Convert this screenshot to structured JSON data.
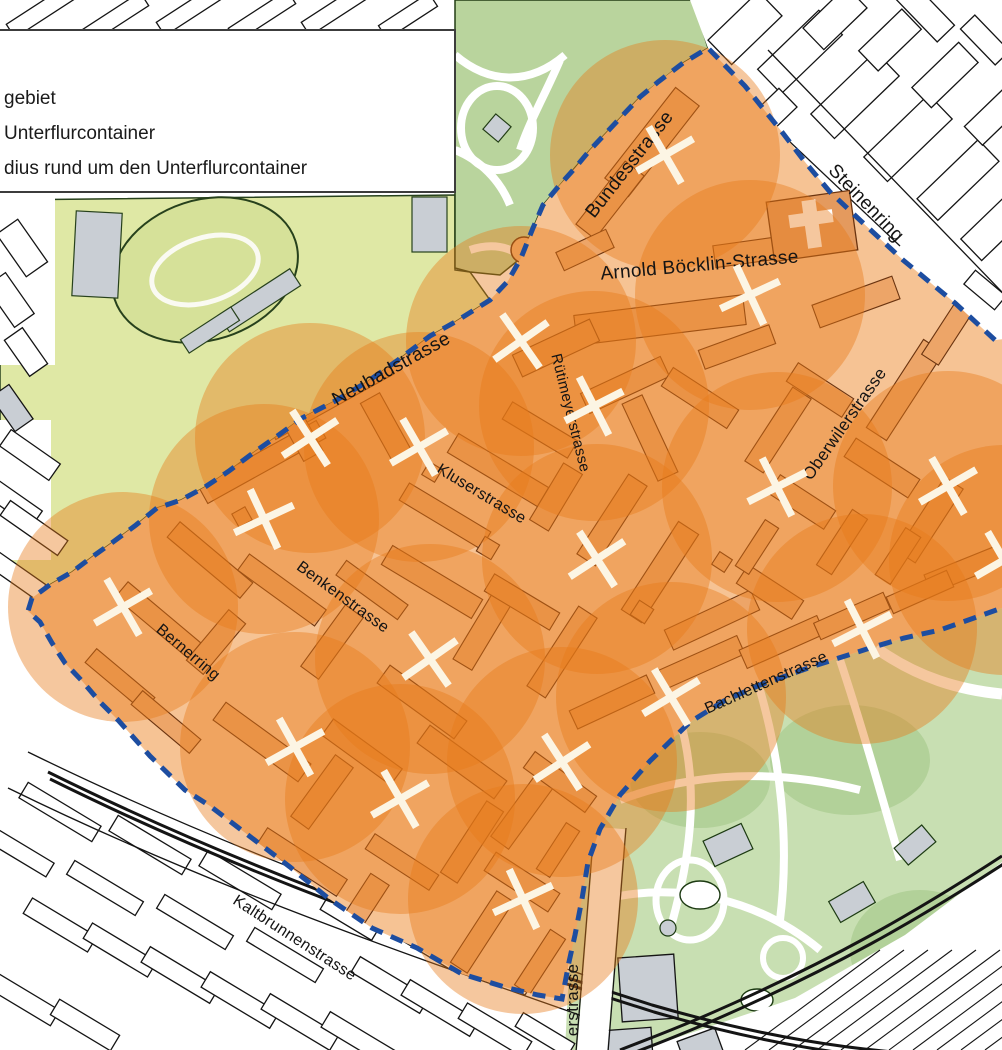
{
  "legend": {
    "lines": [
      "gebiet",
      "Unterflurcontainer",
      "dius rund um den Unterflurcontainer"
    ]
  },
  "map": {
    "colors": {
      "coverage_orange": "#e87a18",
      "coverage_opacity": 0.42,
      "boundary_blue": "#1d4da0",
      "pilot_base": "#f6c394",
      "pilot_building": "#eda568",
      "building_stroke": "#6b3410",
      "marker_cream": "#fcf5e4",
      "park_green": "#b9d49d",
      "park_green_light": "#c8dfb2",
      "field_green": "#dfe8a5",
      "gray_building": "#c9ced4",
      "outline_black": "#141414"
    },
    "coverage_radius_px": 115,
    "containers": [
      {
        "x": 665,
        "y": 155,
        "rot": 15
      },
      {
        "x": 750,
        "y": 295,
        "rot": 20
      },
      {
        "x": 521,
        "y": 341,
        "rot": 10
      },
      {
        "x": 594,
        "y": 406,
        "rot": 18
      },
      {
        "x": 310,
        "y": 438,
        "rot": 12
      },
      {
        "x": 419,
        "y": 447,
        "rot": 15
      },
      {
        "x": 264,
        "y": 519,
        "rot": 20
      },
      {
        "x": 123,
        "y": 607,
        "rot": 15
      },
      {
        "x": 597,
        "y": 559,
        "rot": 12
      },
      {
        "x": 777,
        "y": 487,
        "rot": 18
      },
      {
        "x": 948,
        "y": 486,
        "rot": 15
      },
      {
        "x": 430,
        "y": 659,
        "rot": 10
      },
      {
        "x": 862,
        "y": 629,
        "rot": 18
      },
      {
        "x": 671,
        "y": 697,
        "rot": 14
      },
      {
        "x": 295,
        "y": 747,
        "rot": 16
      },
      {
        "x": 562,
        "y": 762,
        "rot": 12
      },
      {
        "x": 400,
        "y": 799,
        "rot": 15
      },
      {
        "x": 523,
        "y": 899,
        "rot": 20
      },
      {
        "x": 1004,
        "y": 560,
        "rot": 15
      }
    ],
    "streets": [
      {
        "name": "Bundesstrasse",
        "x": 634,
        "y": 168,
        "rot": -52,
        "size": 19
      },
      {
        "name": "Arnold Böcklin-Strasse",
        "x": 700,
        "y": 271,
        "rot": -5,
        "size": 19
      },
      {
        "name": "Steinenring",
        "x": 862,
        "y": 207,
        "rot": 46,
        "size": 19
      },
      {
        "name": "Neubadstrasse",
        "x": 394,
        "y": 374,
        "rot": -29,
        "size": 19
      },
      {
        "name": "Rütimeyerstrasse",
        "x": 566,
        "y": 414,
        "rot": 76,
        "size": 15
      },
      {
        "name": "Kluserstrasse",
        "x": 479,
        "y": 498,
        "rot": 31,
        "size": 16
      },
      {
        "name": "Benkenstrasse",
        "x": 340,
        "y": 601,
        "rot": 36,
        "size": 16
      },
      {
        "name": "Bernerring",
        "x": 185,
        "y": 656,
        "rot": 40,
        "size": 16
      },
      {
        "name": "Oberwilerstrasse",
        "x": 849,
        "y": 427,
        "rot": -55,
        "size": 17
      },
      {
        "name": "Bachlettenstrasse",
        "x": 768,
        "y": 687,
        "rot": -24,
        "size": 16
      },
      {
        "name": "Kaltbrunnenstrasse",
        "x": 292,
        "y": 942,
        "rot": 33,
        "size": 16
      },
      {
        "name": "erstrasse",
        "x": 578,
        "y": 1000,
        "rot": -90,
        "size": 17
      }
    ],
    "boundary": {
      "dash_points": "995,340 955,303 903,260 862,222 830,192 805,162 782,132 745,86 708,48 683,63 658,82 640,97 623,115 607,132 590,150 575,168 558,187 543,205 533,228 521,258 508,281 490,300 455,322 430,336 398,360 367,382 335,401 302,418 276,437 253,453 229,471 205,487 181,500 157,508 136,525 113,542 92,557 72,572 51,584 32,598 28,611 40,622 52,643 65,663 83,682 100,702 118,720 150,756 185,790 210,806 248,835 290,867 328,898 372,928 417,948 462,974 508,988 538,995 562,999 569,962 575,935 582,899 588,862 600,829 620,795 650,761 690,722 724,701 760,685 814,666 870,648 904,638 940,630 974,618 1002,608",
      "close_points": " 1034,612 1034,336"
    }
  }
}
